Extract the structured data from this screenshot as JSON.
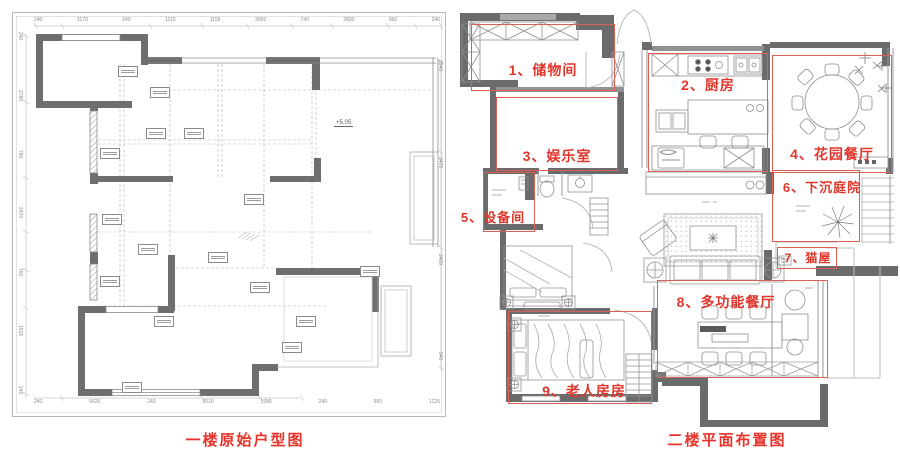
{
  "colors": {
    "annotation_red": "#e0362b",
    "box_red": "#dc5f55",
    "wall_gray": "#6b6b6b",
    "line_gray": "#9a9a9a"
  },
  "left_plan": {
    "caption": "一楼原始户型图",
    "level_marker": "+5.05",
    "dims_top": [
      "240",
      "3170",
      "240",
      "1110",
      "1155",
      "3065",
      "740",
      "2800",
      "960",
      "240"
    ],
    "dims_left": [
      "240",
      "2780",
      "780",
      "2470",
      "760",
      "1515",
      "240"
    ],
    "dims_bottom": [
      "240",
      "5620",
      "240",
      "2010",
      "1990",
      "240",
      "550",
      "1225"
    ],
    "dims_right": [
      "2940",
      "3470",
      "2420",
      "940"
    ]
  },
  "right_plan": {
    "caption": "二楼平面布置图",
    "rooms": [
      {
        "label": "1、储物间"
      },
      {
        "label": "2、厨房"
      },
      {
        "label": "3、娱乐室"
      },
      {
        "label": "4、花园餐厅"
      },
      {
        "label": "5、设备间"
      },
      {
        "label": "6、下沉庭院"
      },
      {
        "label": "7、猫屋"
      },
      {
        "label": "8、多功能餐厅"
      },
      {
        "label": "9、老人房房"
      }
    ]
  }
}
